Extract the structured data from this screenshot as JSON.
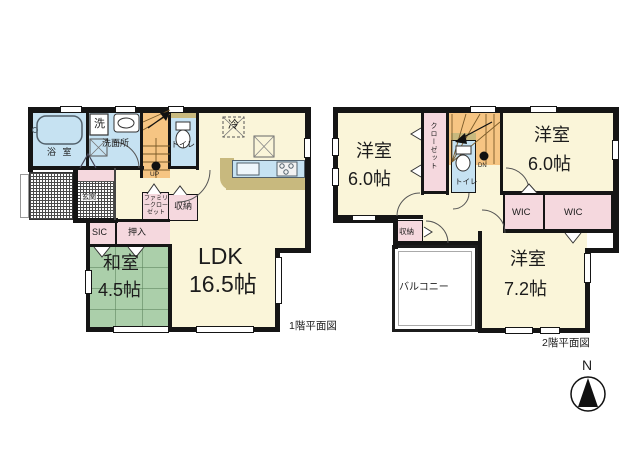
{
  "floor1": {
    "caption": "1階平面図",
    "bath": "浴 室",
    "washer": "洗",
    "washroom": "洗面所",
    "toilet": "トイレ",
    "up": "UP",
    "fridge": "冷",
    "ldk": {
      "name": "LDK",
      "size": "16.5帖"
    },
    "genkan": "玄関",
    "family_closet": "ファミリークローゼット",
    "storage": "収納",
    "sic": "SIC",
    "oshiire": "押入",
    "washitsu": {
      "name": "和室",
      "size": "4.5帖"
    }
  },
  "floor2": {
    "caption": "2階平面図",
    "bedroom_nw": {
      "name": "洋室",
      "size": "6.0帖"
    },
    "closet": "クローゼット",
    "toilet": "トイレ",
    "dn": "DN",
    "bedroom_ne": {
      "name": "洋室",
      "size": "6.0帖"
    },
    "wic_left": "WIC",
    "wic_right": "WIC",
    "storage": "収納",
    "bedroom_se": {
      "name": "洋室",
      "size": "7.2帖"
    },
    "balcony": "バルコニー"
  },
  "compass": {
    "north": "N"
  },
  "colors": {
    "room": "#FAF5D9",
    "tatami": "#ABCFAA",
    "water": "#C6E2F2",
    "closet": "#F5D8DE",
    "stairs": "#F6C583",
    "counter": "#C8B97E",
    "wall": "#151515"
  }
}
